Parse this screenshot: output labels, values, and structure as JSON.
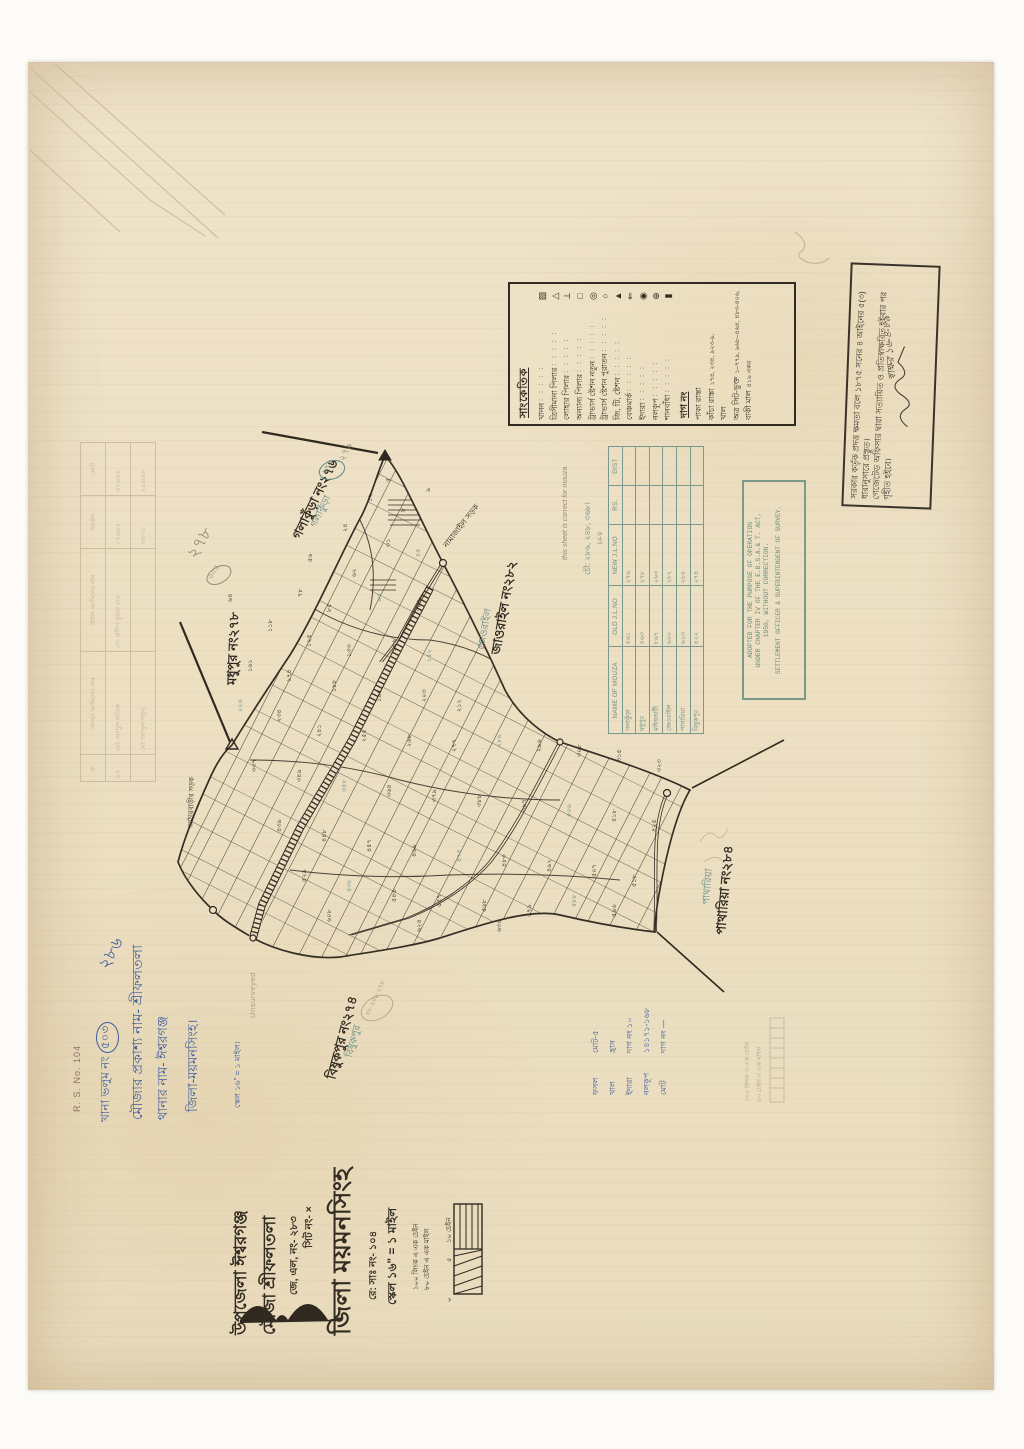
{
  "colors": {
    "ink": "#332c22",
    "blue_ink": "#3f5e9e",
    "teal_pencil": "#5f8a88",
    "pencil": "#9b8a6e",
    "paper": "#ecdfc1",
    "table_ink": "#6b8d85",
    "stamp_teal": "#5f8a7c"
  },
  "certification": {
    "line1": "সরকার কর্তৃক প্রদত্ত ক্ষমতা বলে ১৮৭৫ সনের ৪ আইনের ৫(৩) ধারানুসারে প্রস্তুত।",
    "line2": "গেজেটেড অফিসার দ্বারা সত্যায়িত ও প্রতিস্বাক্ষরিত হইবার পর গৃহীত হইবে।",
    "signature": "স্বাক্ষর ১৬-৪-৮৯"
  },
  "legend": {
    "title": "সাংকেতিক",
    "dots": ": : : : : : :",
    "entries": [
      {
        "label": "খানন",
        "glyph": "▨"
      },
      {
        "label": "ত্রিসীমানা পিলার",
        "glyph": "△"
      },
      {
        "label": "লোহার পিলার",
        "glyph": "⊥"
      },
      {
        "label": "অন্যান্য পিলার",
        "glyph": "□"
      },
      {
        "label": "ট্রাভার্স ষ্টেশন নতুন",
        "glyph": "◎"
      },
      {
        "label": "ট্রাভার্স ষ্টেশন পুরাতন",
        "glyph": "○"
      },
      {
        "label": "জি, টি, ষ্টেশন",
        "glyph": "▲"
      },
      {
        "label": "বেঞ্চমার্ক",
        "glyph": "⇐"
      },
      {
        "label": "ইদারা",
        "glyph": "◉"
      },
      {
        "label": "নলকূপ",
        "glyph": "⊕"
      },
      {
        "label": "শানবাঁধা",
        "glyph": "▮"
      }
    ],
    "dag_heading": "দাগ নং",
    "dag_rows": [
      {
        "label": "পাকা রাস্তা",
        "value": ""
      },
      {
        "label": "কাঁচা রাস্তা",
        "value": "১৭৪, ২৩৪, ৯২৩-৯,"
      },
      {
        "label": "খাল",
        "value": ""
      },
      {
        "label": "অত্র সিট-ভুক্ত",
        "value": "১–৭৭৯, ৯৬৮–৪৬৪, ৪৮৩-৪০৬,"
      },
      {
        "label": "বাকী মাল",
        "value": "৪১৯ একর"
      }
    ]
  },
  "mouza_table": {
    "headers": [
      "NAME OF MOUZA",
      "OLD J.L.NO",
      "NEW J.L.NO",
      "RS.",
      "DIST"
    ],
    "rows": [
      {
        "name": "গলাকুঁড়া",
        "old": "৫৬১",
        "new": "২৭৬",
        "rs": "",
        "dist": ""
      },
      {
        "name": "মধুপুর",
        "old": "৪৬৩",
        "new": "২৭৮",
        "rs": "",
        "dist": ""
      },
      {
        "name": "মাইজহাটী",
        "old": "৮৬৭",
        "new": "২৬৩",
        "rs": "",
        "dist": ""
      },
      {
        "name": "জেওরাইল",
        "old": "৬০০",
        "new": "২৮২",
        "rs": "",
        "dist": ""
      },
      {
        "name": "পাথারিয়া",
        "old": "৬১৩",
        "new": "২৮৪",
        "rs": "",
        "dist": ""
      },
      {
        "name": "বিষুকপুর",
        "old": "৪২২",
        "new": "২৭৪",
        "rs": "",
        "dist": ""
      }
    ],
    "pencil_note": "this sheet is correct for mouza",
    "pencil_numbers": "চৌ: ২৮৬, ২৪৮, ৩৬৮।",
    "pencil_date": "14-9"
  },
  "stamp": {
    "lines": [
      "ADOPTED FOR THE PURPOSE OF OPERATION",
      "UNDER CHAPTER IV OF THE E.B.S.A.& T. ACT,",
      "1950, WITHOUT CORRECTION."
    ],
    "footer": "SETTLEMENT OFFICER & SUPERINTENDENT OF SURVEY."
  },
  "map": {
    "labels": {
      "galakura": "গলাকুঁড়া নং২৭৬",
      "madhupur": "মধুপুর নং২৭৮",
      "jaorail": "জাওরাইল নং২৮২",
      "patharia": "পাথারিয়া নং২৮৪",
      "bishukpur": "বিষুকপুর নং২৭৪"
    },
    "pencil_labels": {
      "galakura": "গলাকুঁড়া",
      "galakura_oval": "২৭৬",
      "galakura_extra": "২৭৯",
      "madhupur_circle": "৩০৪",
      "madhupur_big": "২৭৮",
      "jaorail": "জেওরাইল",
      "patharia": "পাথারিয়া",
      "bishukpur": "বিষুকপুর",
      "bishukpur_oval": "৪৮·৫৪৯·২৭৮",
      "unsurveyed": "Unsurveyed"
    },
    "road_labels": [
      "নামাজাইল সড়ক",
      "আঠারবাড়ীর সড়ক"
    ],
    "plot_numbers": [
      {
        "x": 390,
        "y": 482,
        "n": "৫"
      },
      {
        "x": 372,
        "y": 502,
        "n": "১২"
      },
      {
        "x": 405,
        "y": 512,
        "n": "৮"
      },
      {
        "x": 347,
        "y": 532,
        "n": "২৪"
      },
      {
        "x": 390,
        "y": 547,
        "n": "৩১"
      },
      {
        "x": 420,
        "y": 557,
        "n": "৪৫",
        "c": 1
      },
      {
        "x": 312,
        "y": 562,
        "n": "৫৬"
      },
      {
        "x": 356,
        "y": 577,
        "n": "৬২"
      },
      {
        "x": 302,
        "y": 597,
        "n": "৭৮"
      },
      {
        "x": 331,
        "y": 612,
        "n": "৮৫"
      },
      {
        "x": 381,
        "y": 602,
        "n": "৯৩",
        "c": 1
      },
      {
        "x": 421,
        "y": 612,
        "n": "১০৪"
      },
      {
        "x": 272,
        "y": 632,
        "n": "১১৮"
      },
      {
        "x": 311,
        "y": 647,
        "n": "১২৫"
      },
      {
        "x": 351,
        "y": 657,
        "n": "১৩৩"
      },
      {
        "x": 396,
        "y": 652,
        "n": "১৪৬"
      },
      {
        "x": 431,
        "y": 662,
        "n": "১৫২",
        "c": 1
      },
      {
        "x": 252,
        "y": 672,
        "n": "১৬১"
      },
      {
        "x": 291,
        "y": 682,
        "n": "১৭৪"
      },
      {
        "x": 336,
        "y": 692,
        "n": "১৮৮"
      },
      {
        "x": 381,
        "y": 702,
        "n": "১৯৫"
      },
      {
        "x": 426,
        "y": 702,
        "n": "২০৩"
      },
      {
        "x": 461,
        "y": 712,
        "n": "২১২"
      },
      {
        "x": 242,
        "y": 712,
        "n": "২২৬",
        "c": 1
      },
      {
        "x": 281,
        "y": 722,
        "n": "২৩৪"
      },
      {
        "x": 321,
        "y": 737,
        "n": "২৪১"
      },
      {
        "x": 366,
        "y": 742,
        "n": "২৫৫"
      },
      {
        "x": 411,
        "y": 747,
        "n": "২৬৮"
      },
      {
        "x": 456,
        "y": 752,
        "n": "২৭৭"
      },
      {
        "x": 501,
        "y": 747,
        "n": "২৮৯",
        "c": 1
      },
      {
        "x": 541,
        "y": 752,
        "n": "২৯৬"
      },
      {
        "x": 581,
        "y": 757,
        "n": "৩০৮"
      },
      {
        "x": 621,
        "y": 762,
        "n": "৩১৫"
      },
      {
        "x": 661,
        "y": 772,
        "n": "৩২৩"
      },
      {
        "x": 256,
        "y": 772,
        "n": "৩৩৭"
      },
      {
        "x": 301,
        "y": 782,
        "n": "৩৪৯"
      },
      {
        "x": 346,
        "y": 792,
        "n": "৩৫৮",
        "c": 1
      },
      {
        "x": 391,
        "y": 797,
        "n": "৩৬৪"
      },
      {
        "x": 436,
        "y": 802,
        "n": "৩৭৯"
      },
      {
        "x": 481,
        "y": 807,
        "n": "৩৮৮"
      },
      {
        "x": 526,
        "y": 812,
        "n": "৩৯৭"
      },
      {
        "x": 571,
        "y": 817,
        "n": "৪০৬",
        "c": 1
      },
      {
        "x": 616,
        "y": 822,
        "n": "৪১৮"
      },
      {
        "x": 656,
        "y": 832,
        "n": "৪২৫"
      },
      {
        "x": 281,
        "y": 832,
        "n": "৪৩৯"
      },
      {
        "x": 326,
        "y": 842,
        "n": "৪৪৮"
      },
      {
        "x": 371,
        "y": 852,
        "n": "৪৫৭"
      },
      {
        "x": 416,
        "y": 857,
        "n": "৪৬৯"
      },
      {
        "x": 461,
        "y": 862,
        "n": "৪৭৫",
        "c": 1
      },
      {
        "x": 506,
        "y": 867,
        "n": "৪৮৩"
      },
      {
        "x": 551,
        "y": 872,
        "n": "৪৯২"
      },
      {
        "x": 596,
        "y": 877,
        "n": "৫০৭"
      },
      {
        "x": 636,
        "y": 887,
        "n": "৫১৮"
      },
      {
        "x": 306,
        "y": 882,
        "n": "৫২৯"
      },
      {
        "x": 351,
        "y": 892,
        "n": "৫৩৮",
        "c": 1
      },
      {
        "x": 396,
        "y": 902,
        "n": "৫৪৬"
      },
      {
        "x": 441,
        "y": 907,
        "n": "৫৫৭"
      },
      {
        "x": 486,
        "y": 912,
        "n": "৫৬৮"
      },
      {
        "x": 531,
        "y": 917,
        "n": "৫৭৯"
      },
      {
        "x": 576,
        "y": 907,
        "n": "৫৮৮",
        "c": 1
      },
      {
        "x": 616,
        "y": 917,
        "n": "৫৯৬"
      },
      {
        "x": 331,
        "y": 922,
        "n": "৬০৮"
      },
      {
        "x": 421,
        "y": 932,
        "n": "৬২৪"
      },
      {
        "x": 501,
        "y": 932,
        "n": "৬৩৫"
      },
      {
        "x": 232,
        "y": 602,
        "n": "৬৪"
      },
      {
        "x": 430,
        "y": 492,
        "n": "৯"
      }
    ]
  },
  "summary_notes": {
    "rows": [
      {
        "c1": "ফসল",
        "c2": "মোট-৫"
      },
      {
        "c1": "খাল",
        "c2": "হ্রাস"
      },
      {
        "c1": "ইদারা",
        "c2": "দাগ নং ১০"
      },
      {
        "c1": "নলকূপ",
        "c2": "১৪১৭১-১৬৮"
      },
      {
        "c1": "মোট",
        "c2": "দাগ নং —"
      }
    ]
  },
  "pencil_table": {
    "headers": [
      "ক্র:",
      "খসড়া আমিনের নাম",
      "প্রধান আমিনের নাম",
      "আবাদ",
      "মোট"
    ],
    "rows": [
      {
        "c0": "৮৭",
        "c1": "মো: আব্দুল লতিফ",
        "c2": "সে: প্রদীপ কুমার রায়",
        "c3": "২৭৬৷৪৮",
        "c4": "৩৭৬৷৪৮"
      },
      {
        "c0": "",
        "c1": "মো: আব্দুল গফুর",
        "c2": "",
        "c3": "৭৷৬৭৮",
        "c4": "২৯৬৷৪৮"
      }
    ]
  },
  "hand_block": {
    "rs_no": "R. S. No. 104",
    "num_286": "২৮৬",
    "volume_label": "খানা ভলুম নং",
    "volume_value": "৫০৩",
    "mouza_line": "মৌজার প্রকাশ্য নাম- শ্রীফলতলা",
    "thana_line": "থানার নাম- ঈশ্বরগঞ্জ",
    "zila_line": "জিলা-ময়মনসিংহ।",
    "scale_line": "স্কেল ১৬\" = ১ মাইল।"
  },
  "title_block": {
    "upazila": "উপজেলা  ঈশ্বরগঞ্জ",
    "mouza": "মৌজা  শ্রীফলতলা",
    "jl_no": "জে, এল, নং- ২৮৩",
    "sheet_no": "সিট নং- ×",
    "zila": "জিলা  ময়মনসিংহ",
    "rs_no": "রে: সাঃ নং- ১০৪",
    "scale": "স্কেল ১৬\" = ১ মাইল",
    "scale_notes": [
      "১০০ লিংক এ এক চেইন",
      "৮০ চেইন এ এক মাইল"
    ],
    "scale_bar_labels": [
      "১০ চেইন",
      "৫",
      "০"
    ]
  }
}
